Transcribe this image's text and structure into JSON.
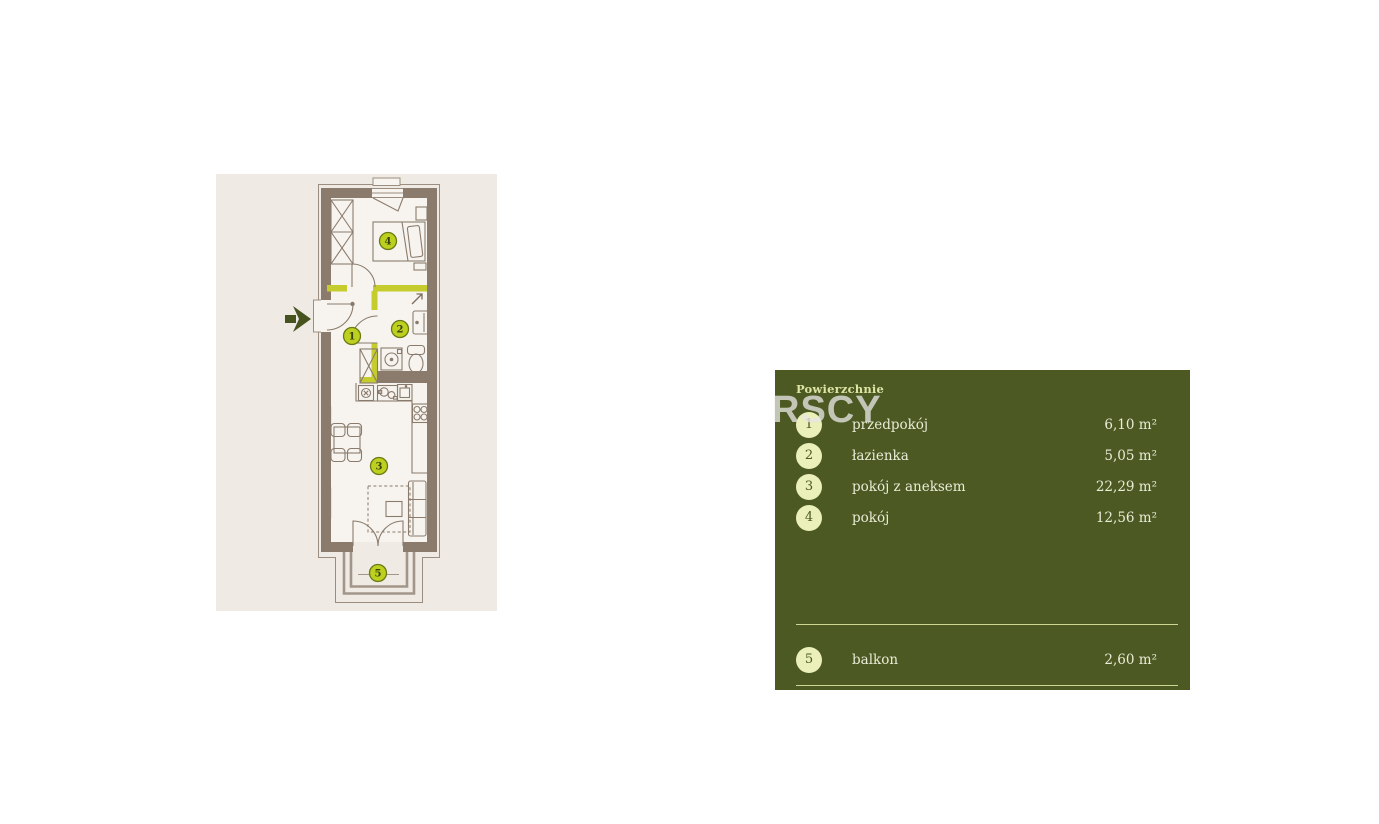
{
  "legend": {
    "title": "Powierzchnie",
    "watermark": "RSCY",
    "rows": [
      {
        "num": "1",
        "label": "przedpokój",
        "area": "6,10 m²"
      },
      {
        "num": "2",
        "label": "łazienka",
        "area": "5,05 m²"
      },
      {
        "num": "3",
        "label": "pokój z aneksem",
        "area": "22,29 m²"
      },
      {
        "num": "4",
        "label": "pokój",
        "area": "12,56 m²"
      },
      {
        "num": "5",
        "label": "balkon",
        "area": "2,60 m²"
      }
    ]
  },
  "plan": {
    "markers": [
      {
        "num": "1",
        "x": 352,
        "y": 336
      },
      {
        "num": "2",
        "x": 400,
        "y": 329
      },
      {
        "num": "3",
        "x": 379,
        "y": 466
      },
      {
        "num": "4",
        "x": 388,
        "y": 241
      },
      {
        "num": "5",
        "x": 378,
        "y": 573
      }
    ],
    "icons": {
      "entrance": "entrance-arrow",
      "bathroom_vent": "up-right-arrow"
    }
  },
  "colors": {
    "panel_bg": "#4c5923",
    "badge_bg": "#ebefb9",
    "panel_text": "#e9ecd6",
    "divider": "#cdd693",
    "accent_lime": "#c5cc2e",
    "marker_fill": "#bdd01f",
    "wall_brown": "#8a7b6d",
    "card_bg": "#efeae3",
    "entrance_arrow": "#47531f"
  }
}
